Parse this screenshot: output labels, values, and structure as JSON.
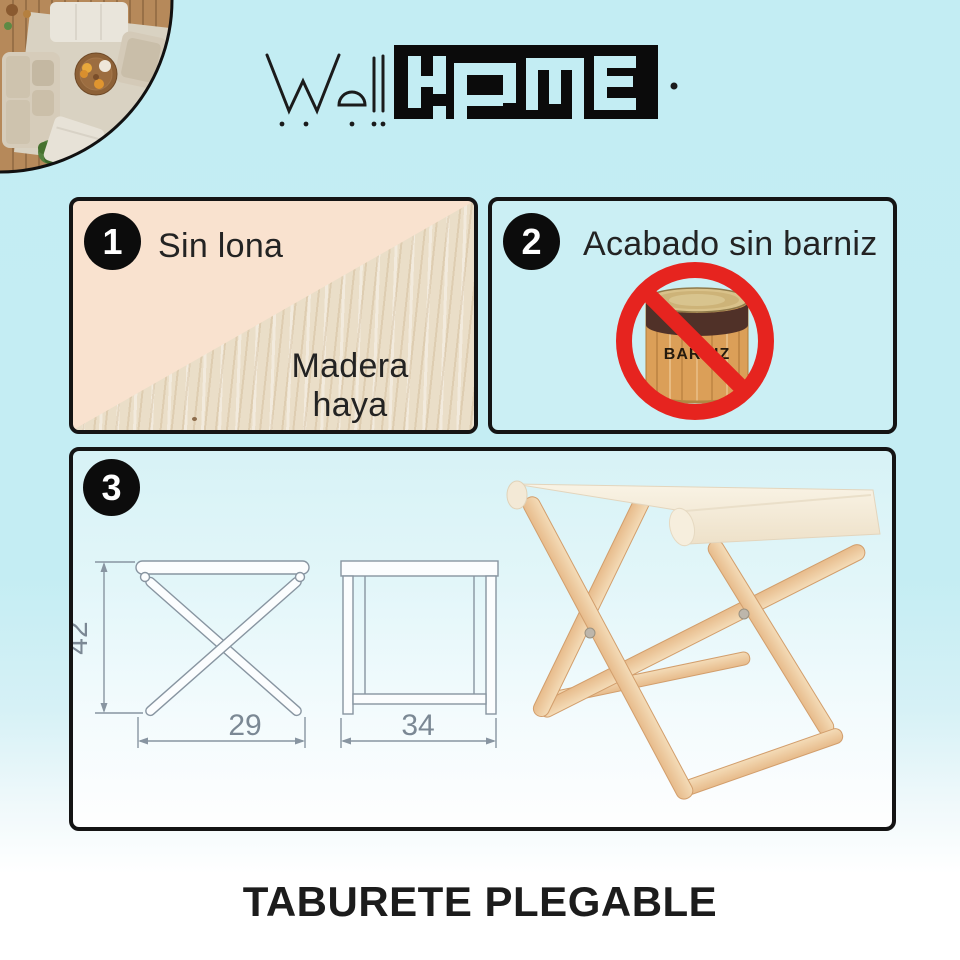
{
  "logo": {
    "well": "Well",
    "home": "HOME"
  },
  "panel1": {
    "number": "1",
    "label_top": "Sin lona",
    "label_bottom": "Madera haya"
  },
  "panel2": {
    "number": "2",
    "label": "Acabado sin barniz",
    "can_text": "BARNIZ"
  },
  "panel3": {
    "number": "3",
    "dim_height": "42",
    "dim_width": "29",
    "dim_depth": "34"
  },
  "page": {
    "title": "TABURETE PLEGABLE"
  },
  "colors": {
    "background_cyan": "#c3edf3",
    "panel_peach": "#f9e2cf",
    "wood_beige": "#eadec8",
    "prohibition_red": "#e6241f",
    "pine_wood": "#eec79c",
    "canvas_cream": "#f6efe0",
    "drawing_gray": "#8895a1",
    "black": "#141414"
  }
}
